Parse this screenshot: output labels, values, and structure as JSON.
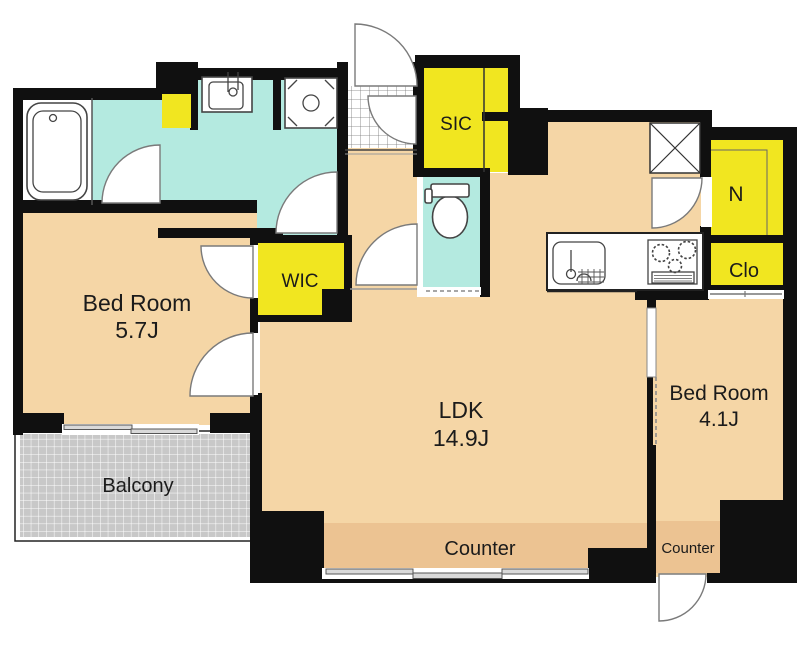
{
  "plan": {
    "labels": {
      "bedroom1_name": "Bed Room",
      "bedroom1_size": "5.7J",
      "ldk_name": "LDK",
      "ldk_size": "14.9J",
      "bedroom2_name": "Bed Room",
      "bedroom2_size": "4.1J",
      "balcony": "Balcony",
      "counter_main": "Counter",
      "counter_sub": "Counter",
      "wic": "WIC",
      "sic": "SIC",
      "storage_n": "N",
      "closet": "Clo"
    },
    "colors": {
      "wall": "#101010",
      "floor": "#F5D6A6",
      "counter": "#ECC392",
      "wet": "#B4EAE0",
      "closet": "#F1E620",
      "balcony": "#C8C8C8"
    }
  }
}
